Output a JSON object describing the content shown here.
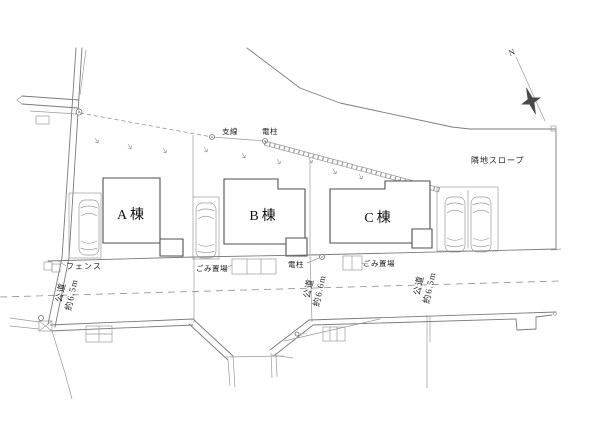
{
  "plan": {
    "north": {
      "label": "N"
    },
    "annotations": {
      "guy_wire": "支線",
      "pole_upper": "電柱",
      "neighbor_slope": "隣地スロープ",
      "fence": "フェンス",
      "garbage_left": "ごみ置場",
      "pole_lower": "電柱",
      "garbage_right": "ごみ置場"
    },
    "buildings": [
      {
        "label": "A棟"
      },
      {
        "label": "B棟"
      },
      {
        "label": "C棟"
      }
    ],
    "roads": [
      {
        "name": "公道",
        "width": "約6.5m",
        "position": "left"
      },
      {
        "name": "公道",
        "width": "約6.6m",
        "position": "center"
      },
      {
        "name": "公道",
        "width": "約6.5m",
        "position": "right"
      }
    ],
    "colors": {
      "line": "#7a7a7a",
      "building_line": "#4f4f4f",
      "text": "#1c1c1c",
      "background": "#ffffff",
      "north_star": "#4a4a4a"
    }
  }
}
